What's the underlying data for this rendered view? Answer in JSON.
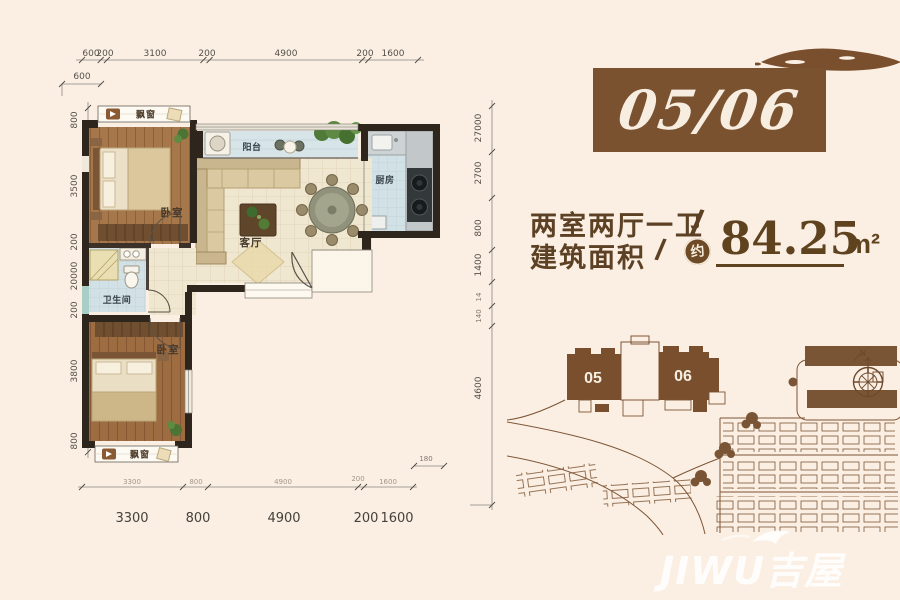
{
  "unit": {
    "number": "05/06"
  },
  "spec": {
    "rooms_text": "两室两厅一卫",
    "area_label": "建筑面积",
    "slash": "/",
    "approx_badge": "约",
    "area_value": "84.25",
    "area_unit": "m²"
  },
  "floor_plan": {
    "rooms": {
      "bedroom_top": "卧室",
      "balcony": "阳台",
      "kitchen": "厨房",
      "living": "客厅",
      "bathroom": "卫生间",
      "bedroom_bottom": "卧室",
      "bay_window_top": "飘窗",
      "bay_window_bottom": "飘窗"
    },
    "dimensions": {
      "top": [
        "600",
        "200",
        "3100",
        "200",
        "4900",
        "200",
        "1600"
      ],
      "top_secondary": "600",
      "bottom": [
        "3300",
        "800",
        "4900",
        "200",
        "1600"
      ],
      "left": [
        "800",
        "3500",
        "200",
        "20000",
        "200",
        "3800",
        "800"
      ],
      "right": [
        "27000",
        "2700",
        "800",
        "1400",
        "14",
        "140",
        "4600"
      ],
      "extra": "180"
    }
  },
  "site_plan": {
    "unit_labels": [
      "05",
      "06"
    ],
    "compass_north": "N"
  },
  "watermark": {
    "text": "JIWU吉屋"
  },
  "colors": {
    "accent_brown": "#7a5230",
    "text_brown": "#5d4124",
    "wall_dark": "#2e251d",
    "wood_floor": "#a6774b",
    "tile_floor": "#f0e7d1",
    "wet_floor": "#d2e1e5",
    "site_outline": "#7d5535"
  }
}
